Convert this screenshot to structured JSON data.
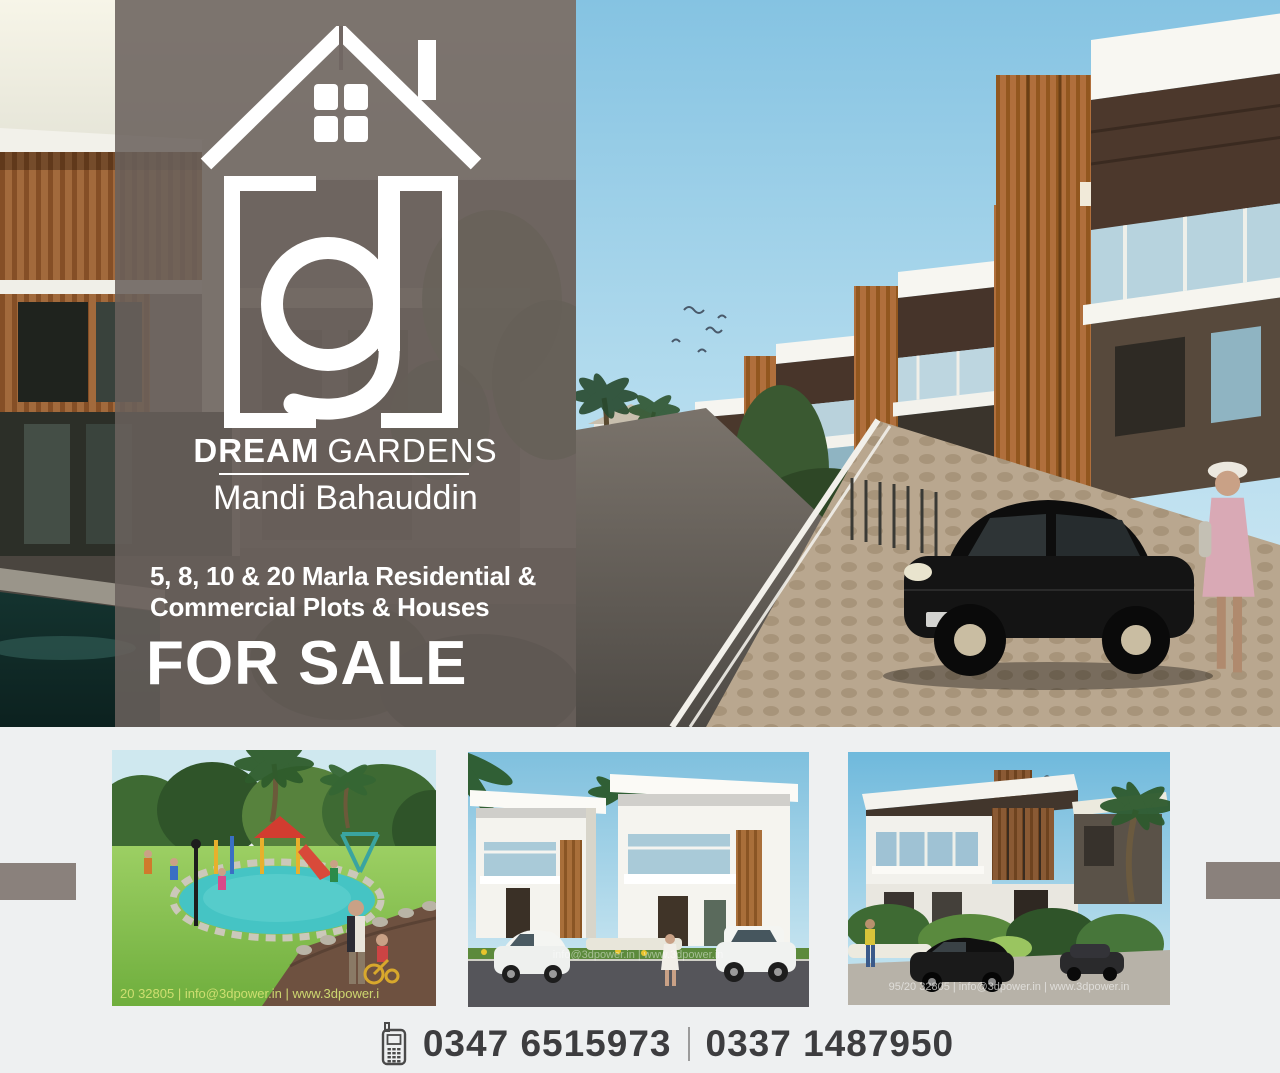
{
  "page": {
    "background": "#eef0f1",
    "accent_rect_color": "#8a817c"
  },
  "hero": {
    "overlay_color": "#6a605c",
    "logo_icon": "house-monogram-logo-icon",
    "brand": {
      "word1": "DREAM",
      "word2": "GARDENS",
      "city": "Mandi Bahauddin"
    },
    "offer": {
      "line1": "5, 8, 10 & 20 Marla Residential &",
      "line2": "Commercial Plots & Houses"
    },
    "headline": "FOR SALE"
  },
  "thumbnails": {
    "playground": {
      "watermark": "20 32805 | info@3dpower.in | www.3dpower.i"
    },
    "villas": {
      "watermark": "info@3dpower.in | www.3dpower.in"
    },
    "houses": {
      "watermark": "95/20 32805 | info@3dpower.in | www.3dpower.in"
    }
  },
  "contact": {
    "icon": "mobile-phone-icon",
    "phone1": "0347 6515973",
    "separator": "|",
    "phone2": "0337 1487950",
    "text_color": "#3d3d3f"
  }
}
